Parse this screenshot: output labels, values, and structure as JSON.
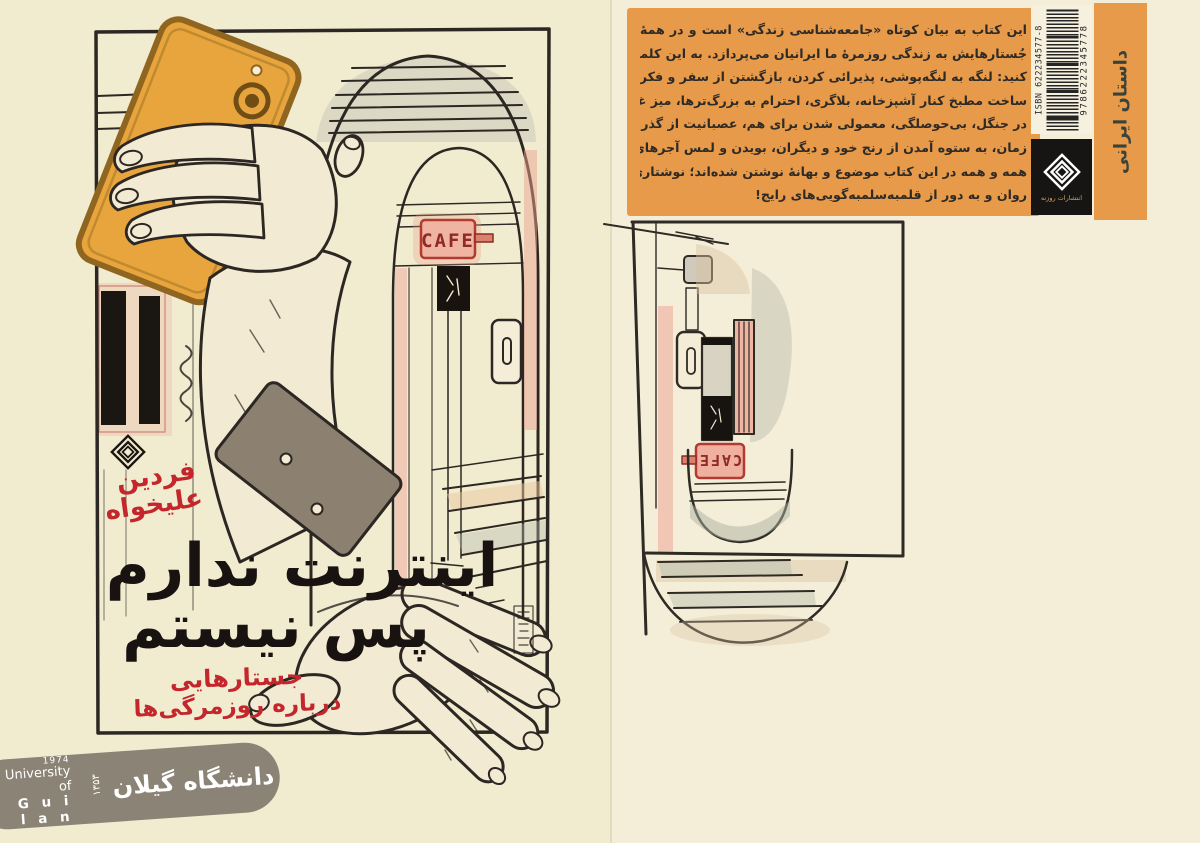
{
  "front_cover": {
    "author_first_name": "فردین",
    "author_last_name": "علیخواه",
    "title_line1": "اینترنت ندارم",
    "title_line2": "پس نیستم",
    "subtitle_line1": "جستارهایی",
    "subtitle_line2": "درباره روزمرگی‌ها",
    "cafe_sign_text": "CAFE"
  },
  "back_cover": {
    "blurb_lines": [
      "این کتاب به بیان کوتاه «جامعه‌شناسی زندگی» است و در همهٔ",
      "جُستارهایش به زندگی روزمرهٔ ما ایرانیان می‌پردازد. به این کلمات دقت",
      "کنید: لنگه به لنگه‌پوشی، پذیرائی کردن، بازگشتن از سفر و فکر به طلاق،",
      "ساخت مطبخ کنار آشپزخانه، بلاگری، احترام به بزرگ‌ترها، میز غذا چیدن",
      "در جنگل، بی‌حوصلگی، معمولی شدن برای هم، عصبانیت از گذر سریع",
      "زمان، به ستوه آمدن از رنج خود و دیگران، بویدن و لمس آجرهای کهنه!",
      "همه و همه در این کتاب موضوع و بهانهٔ نوشتن شده‌اند؛ نوشتاری با نثری",
      "روان و به دور از قلمبه‌سلمبه‌گویی‌های رایج!"
    ],
    "cafe_sign_text": "CAFE",
    "isbn_label": "ISBN 622234577-8",
    "barcode_digits": "9786222345778",
    "publisher_name": "انتشارات روزنه",
    "category_label": "داستان ایرانی"
  },
  "watermark": {
    "year_en": "1974",
    "university_line1": "University of",
    "university_line2": "G u i l a n",
    "year_fa": "۱۳۵۳",
    "name_fa": "دانشگاه گیلان"
  },
  "colors": {
    "background": "#f2ecd2",
    "accent_orange": "#e79a49",
    "accent_red": "#c4262c",
    "ink_black": "#1a1511",
    "phone_orange": "#e8a53e",
    "banner_grey": "#8b8375"
  }
}
